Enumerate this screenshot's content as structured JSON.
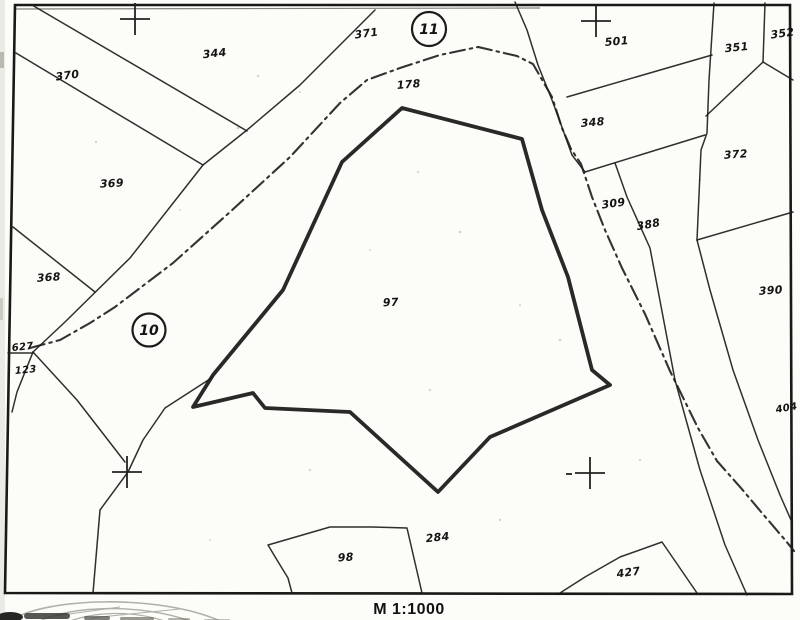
{
  "map": {
    "parcel_labels": {
      "p344": "344",
      "p370": "370",
      "p369": "369",
      "p368": "368",
      "p627": "627",
      "p123": "123",
      "p371": "371",
      "p178": "178",
      "p97": "97",
      "p501": "501",
      "p351": "351",
      "p352": "352",
      "p348": "348",
      "p372": "372",
      "p309": "309",
      "p388": "388",
      "p390": "390",
      "p404": "404",
      "p284": "284",
      "p98": "98",
      "p427": "427"
    },
    "sheet_markers": {
      "left": "10",
      "top": "11"
    },
    "scale_text": "M 1:1000",
    "colors": {
      "ink": "#1d1d1b",
      "paper": "#fcfcf8",
      "stamp_gray": "#b0b0a8"
    }
  }
}
